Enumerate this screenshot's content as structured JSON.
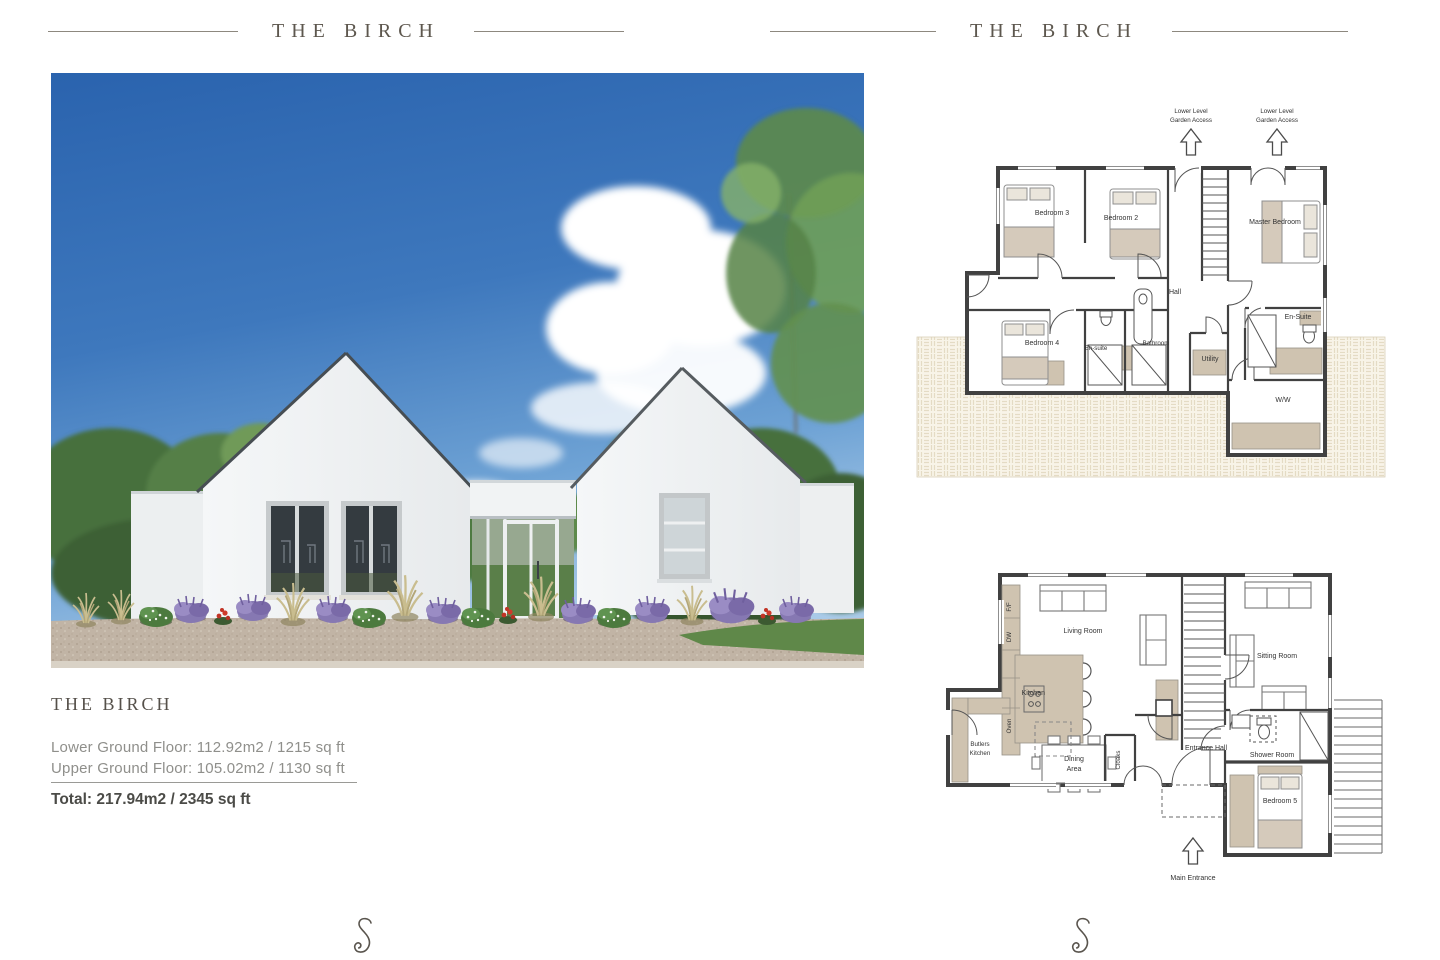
{
  "header_left": {
    "title": "THE BIRCH"
  },
  "header_right": {
    "title": "THE BIRCH"
  },
  "summary": {
    "name": "THE BIRCH",
    "lower": "Lower Ground Floor: 112.92m2 / 1215 sq ft",
    "upper": "Upper Ground Floor: 105.02m2 / 1130 sq ft",
    "total": "Total: 217.94m2 / 2345 sq ft"
  },
  "fp1": {
    "access1": {
      "l1": "Lower Level",
      "l2": "Garden Access"
    },
    "access2": {
      "l1": "Lower Level",
      "l2": "Garden Access"
    },
    "bedroom3": "Bedroom 3",
    "bedroom2": "Bedroom 2",
    "master": "Master Bedroom",
    "hall": "Hall",
    "bedroom4": "Bedroom 4",
    "ensuite_small": "En-suite",
    "bathroom": "Bathroom",
    "utility": "Utility",
    "ensuite": "En-Suite",
    "ww": "W/W"
  },
  "fp2": {
    "living": "Living Room",
    "kitchen": "Kitchen",
    "sitting": "Sitting Room",
    "butlers": {
      "l1": "Butlers",
      "l2": "Kitchen"
    },
    "dining": {
      "l1": "Dining",
      "l2": "Area"
    },
    "cloaks": "Cloaks",
    "entrance_hall": "Entrance Hall",
    "shower": "Shower Room",
    "bedroom5": "Bedroom 5",
    "ff": "F/F",
    "dw": "DW",
    "oven": "Oven",
    "main_entrance": "Main Entrance"
  }
}
